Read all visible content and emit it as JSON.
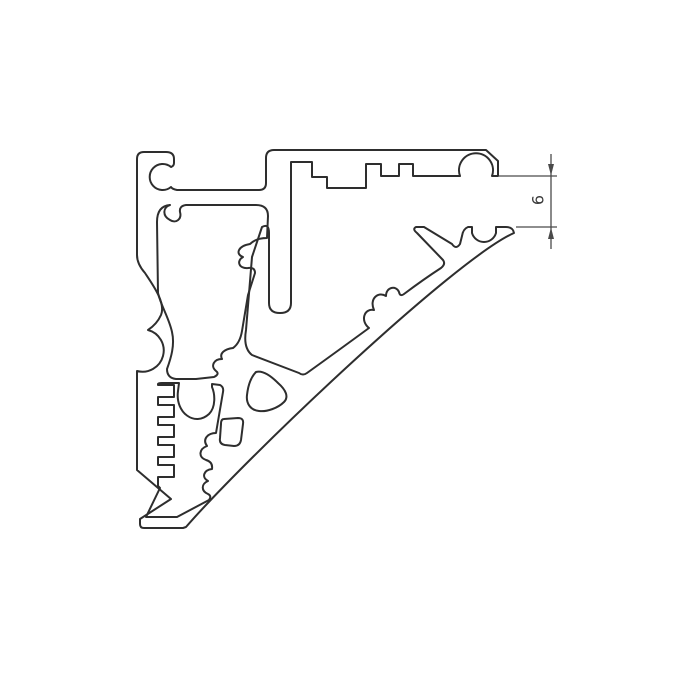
{
  "drawing": {
    "background": "#ffffff",
    "line_color": "#2e2e2e",
    "dimension": {
      "label": "6",
      "color": "#4a4a4a"
    }
  }
}
